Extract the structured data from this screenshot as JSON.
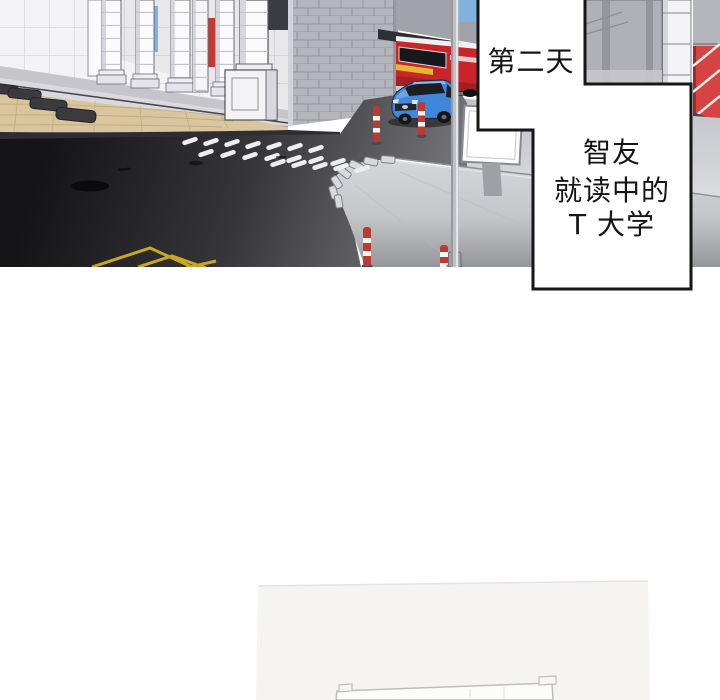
{
  "captions": {
    "day": "第二天",
    "location_lines": [
      "智友",
      "就读中的",
      "T 大学"
    ]
  },
  "palette": {
    "caption_border": "#161616",
    "caption_bg": "#ffffff",
    "caption_text": "#141414",
    "bus_red": "#c8242a",
    "bus_stripe_yellow": "#e2b92e",
    "car_blue": "#4187d9",
    "asphalt_dark": "#17171a",
    "concrete_light": "#d2d3d7",
    "plaza_tan": "#d9c59e",
    "crosswalk_white": "#edeef0",
    "road_marking_yellow": "#d2ae20",
    "bollard_red": "#c0392f",
    "sky_blue": "#7fb2dc",
    "truss_red": "#d64343",
    "column_white": "#fbfbfd",
    "brick_gray": "#b5b6bc"
  }
}
